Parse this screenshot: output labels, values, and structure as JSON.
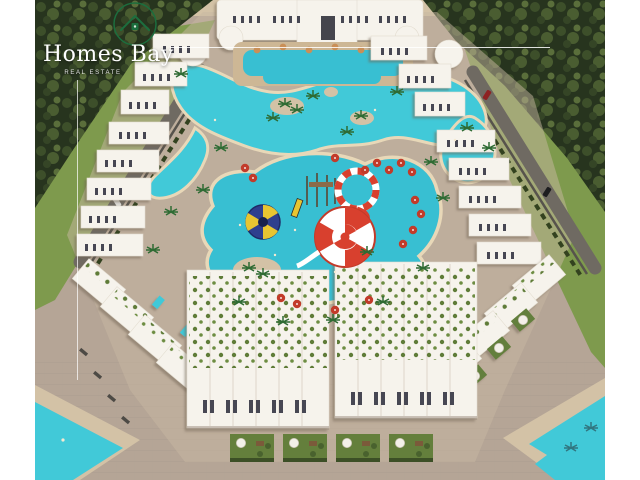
{
  "window": {
    "width": 640,
    "height": 480,
    "matte_color": "#ffffff"
  },
  "overlay": {
    "brand": "Homes Bay",
    "tagline": "Real Estate",
    "logo_icon": "house-in-circle-icon",
    "frame_lines": "thin-white-divider-lines"
  },
  "scene": {
    "type": "aerial-architectural-render",
    "description": "Bird's-eye 3D render of the Homes Bay resort: white low-rise apartment buildings and villas arranged in a ring around a turquoise lagoon pool with a red-and-white funnel water slide, loop slide and blue funnel slide, pine forest at the top, lawns with access roads on the sides, paved plaza with garden squares at the bottom and turquoise beach pools in the lower corners",
    "colors": {
      "lagoon": "#41c9d8",
      "pool": "#38bfd2",
      "sand": "#d3c2a6",
      "paving": "#b5a596",
      "forest": "#27341e",
      "lawn": "#7e9a4d",
      "building": "#f6f3ec",
      "slide_red": "#d8402e",
      "slide_yellow": "#e8c531",
      "slide_blue": "#2e3f8e",
      "umbrella_red": "#c23b2a",
      "logo_green": "#1c6e3e",
      "text": "#ffffff"
    }
  }
}
